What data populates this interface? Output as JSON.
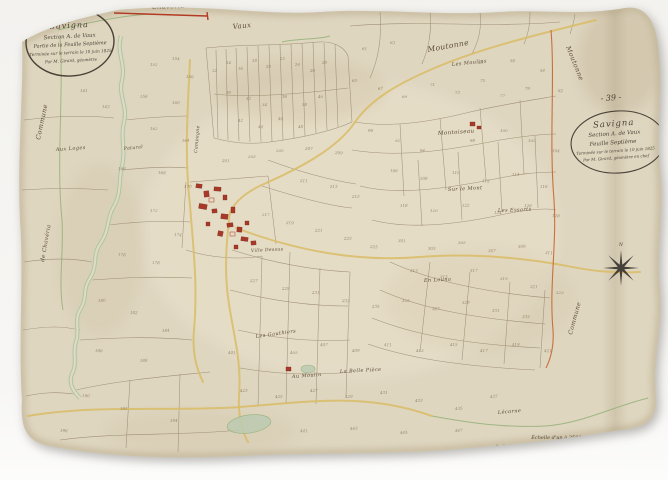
{
  "document": {
    "description": "Scanned hand-drawn Napoleonic cadastre map sheet on aged paper",
    "commune": "Savigna",
    "section": "Section A. de Vaux",
    "sheet": "Feuille Septième"
  },
  "cartouche_left": {
    "title": "Savigna",
    "line2": "Section A. de Vaux",
    "line3": "Partie de la Feuille Septième",
    "line4": "Terminée sur le terrain le 10 juin 1825",
    "line5": "Par M. Girard, géomètre"
  },
  "cartouche_right": {
    "page_number": "- 39 -",
    "title": "Savigna",
    "line2": "Section A. de Vaux",
    "line3": "Feuille Septième",
    "line4": "Terminée sur le terrain le 10 juin 1825",
    "line5": "Par M. Girard, géomètre en chef"
  },
  "stamps": {
    "bottom_left_page_number": "7"
  },
  "scale_bar": {
    "label": "Échelle d'un à 2500 mètres"
  },
  "compass": {
    "north_label": "N"
  },
  "colors": {
    "paper": "#dfd6c0",
    "parcel_line": "#8a795d",
    "road": "#d9bc66",
    "river": "#a9c29b",
    "boundary_red": "#b23b25",
    "boundary_orange": "#c4652f",
    "building_red": "#a83828",
    "ink": "#4e4234"
  },
  "map": {
    "place_labels": [
      {
        "text": "Vaux",
        "x": 233,
        "y": 29,
        "rot": -6,
        "size": 7
      },
      {
        "text": "Moutonne",
        "x": 428,
        "y": 52,
        "rot": -10,
        "size": 7.5
      },
      {
        "text": "Les Moulins",
        "x": 452,
        "y": 66,
        "rot": -6,
        "size": 5
      },
      {
        "text": "Montoiseau",
        "x": 438,
        "y": 135,
        "rot": -4,
        "size": 5.5
      },
      {
        "text": "Sur le Mont",
        "x": 448,
        "y": 191,
        "rot": -3,
        "size": 5
      },
      {
        "text": "Les Essarts",
        "x": 498,
        "y": 212,
        "rot": -2,
        "size": 5
      },
      {
        "text": "En Louna",
        "x": 424,
        "y": 282,
        "rot": -3,
        "size": 5
      },
      {
        "text": "Aux Loges",
        "x": 56,
        "y": 151,
        "rot": -4,
        "size": 5
      },
      {
        "text": "Patural",
        "x": 124,
        "y": 150,
        "rot": -6,
        "size": 4.5
      },
      {
        "text": "Les Gauthiers",
        "x": 256,
        "y": 338,
        "rot": -8,
        "size": 5
      },
      {
        "text": "Au Moulin",
        "x": 292,
        "y": 378,
        "rot": -4,
        "size": 5
      },
      {
        "text": "La Belle Pièce",
        "x": 340,
        "y": 373,
        "rot": -3,
        "size": 5
      },
      {
        "text": "Ville Dessus",
        "x": 251,
        "y": 252,
        "rot": -3,
        "size": 4.5
      },
      {
        "text": "Lécorne",
        "x": 498,
        "y": 414,
        "rot": -5,
        "size": 5
      },
      {
        "text": "Campagne",
        "x": 197,
        "y": 153,
        "rot": -85,
        "size": 4.5
      },
      {
        "text": "Commune",
        "x": 40,
        "y": 140,
        "rot": -78,
        "size": 6.5
      },
      {
        "text": "de Chavéria",
        "x": 44,
        "y": 262,
        "rot": -80,
        "size": 5.5
      },
      {
        "text": "Commune",
        "x": 572,
        "y": 335,
        "rot": -75,
        "size": 6
      },
      {
        "text": "Moutonne",
        "x": 566,
        "y": 47,
        "rot": 68,
        "size": 6.5,
        "color": "#9a5030"
      },
      {
        "text": "Chavéria",
        "x": 152,
        "y": 9,
        "rot": -2,
        "size": 6.5,
        "color": "#7a3c22"
      }
    ],
    "parcel_numbers": [
      [
        80,
        92,
        "141"
      ],
      [
        102,
        108,
        "143"
      ],
      [
        150,
        66,
        "152"
      ],
      [
        172,
        60,
        "154"
      ],
      [
        186,
        78,
        "156"
      ],
      [
        140,
        98,
        "158"
      ],
      [
        172,
        104,
        "160"
      ],
      [
        150,
        130,
        "162"
      ],
      [
        182,
        142,
        "164"
      ],
      [
        118,
        170,
        "166"
      ],
      [
        158,
        174,
        "168"
      ],
      [
        184,
        188,
        "170"
      ],
      [
        150,
        212,
        "172"
      ],
      [
        174,
        236,
        "174"
      ],
      [
        118,
        256,
        "176"
      ],
      [
        152,
        264,
        "178"
      ],
      [
        98,
        302,
        "180"
      ],
      [
        130,
        314,
        "182"
      ],
      [
        162,
        332,
        "184"
      ],
      [
        95,
        352,
        "186"
      ],
      [
        140,
        362,
        "188"
      ],
      [
        82,
        397,
        "190"
      ],
      [
        120,
        410,
        "192"
      ],
      [
        170,
        422,
        "194"
      ],
      [
        60,
        432,
        "196"
      ],
      [
        212,
        72,
        "12"
      ],
      [
        226,
        64,
        "14"
      ],
      [
        238,
        70,
        "16"
      ],
      [
        252,
        62,
        "18"
      ],
      [
        266,
        68,
        "20"
      ],
      [
        280,
        60,
        "22"
      ],
      [
        295,
        66,
        "24"
      ],
      [
        310,
        72,
        "26"
      ],
      [
        322,
        64,
        "28"
      ],
      [
        226,
        94,
        "30"
      ],
      [
        246,
        100,
        "32"
      ],
      [
        262,
        106,
        "34"
      ],
      [
        282,
        98,
        "36"
      ],
      [
        302,
        106,
        "38"
      ],
      [
        318,
        98,
        "40"
      ],
      [
        238,
        122,
        "42"
      ],
      [
        258,
        128,
        "44"
      ],
      [
        278,
        120,
        "46"
      ],
      [
        298,
        128,
        "48"
      ],
      [
        362,
        50,
        "61"
      ],
      [
        390,
        44,
        "63"
      ],
      [
        352,
        82,
        "65"
      ],
      [
        378,
        90,
        "67"
      ],
      [
        402,
        98,
        "69"
      ],
      [
        430,
        86,
        "71"
      ],
      [
        455,
        94,
        "73"
      ],
      [
        480,
        82,
        "75"
      ],
      [
        500,
        97,
        "77"
      ],
      [
        525,
        90,
        "79"
      ],
      [
        478,
        64,
        "58"
      ],
      [
        510,
        62,
        "56"
      ],
      [
        540,
        72,
        "54"
      ],
      [
        558,
        92,
        "82"
      ],
      [
        368,
        132,
        "90"
      ],
      [
        395,
        142,
        "92"
      ],
      [
        420,
        152,
        "94"
      ],
      [
        470,
        142,
        "98"
      ],
      [
        500,
        132,
        "100"
      ],
      [
        528,
        142,
        "102"
      ],
      [
        552,
        152,
        "104"
      ],
      [
        390,
        172,
        "106"
      ],
      [
        420,
        180,
        "108"
      ],
      [
        452,
        174,
        "110"
      ],
      [
        482,
        182,
        "112"
      ],
      [
        512,
        176,
        "114"
      ],
      [
        540,
        188,
        "116"
      ],
      [
        400,
        207,
        "118"
      ],
      [
        430,
        212,
        "120"
      ],
      [
        462,
        207,
        "122"
      ],
      [
        494,
        214,
        "124"
      ],
      [
        524,
        207,
        "126"
      ],
      [
        552,
        217,
        "128"
      ],
      [
        222,
        162,
        "201"
      ],
      [
        248,
        158,
        "203"
      ],
      [
        276,
        152,
        "205"
      ],
      [
        305,
        150,
        "207"
      ],
      [
        335,
        154,
        "209"
      ],
      [
        300,
        182,
        "211"
      ],
      [
        330,
        188,
        "213"
      ],
      [
        352,
        198,
        "215"
      ],
      [
        262,
        216,
        "217"
      ],
      [
        286,
        224,
        "219"
      ],
      [
        315,
        232,
        "221"
      ],
      [
        344,
        240,
        "223"
      ],
      [
        370,
        248,
        "225"
      ],
      [
        250,
        282,
        "227"
      ],
      [
        282,
        290,
        "229"
      ],
      [
        312,
        294,
        "231"
      ],
      [
        342,
        302,
        "233"
      ],
      [
        372,
        308,
        "235"
      ],
      [
        398,
        242,
        "301"
      ],
      [
        428,
        250,
        "303"
      ],
      [
        458,
        244,
        "305"
      ],
      [
        488,
        252,
        "307"
      ],
      [
        518,
        248,
        "309"
      ],
      [
        545,
        254,
        "311"
      ],
      [
        410,
        272,
        "313"
      ],
      [
        440,
        278,
        "315"
      ],
      [
        470,
        272,
        "317"
      ],
      [
        500,
        280,
        "319"
      ],
      [
        530,
        288,
        "321"
      ],
      [
        556,
        294,
        "323"
      ],
      [
        402,
        302,
        "325"
      ],
      [
        432,
        310,
        "327"
      ],
      [
        462,
        304,
        "329"
      ],
      [
        492,
        312,
        "331"
      ],
      [
        522,
        318,
        "333"
      ],
      [
        228,
        354,
        "401"
      ],
      [
        290,
        354,
        "405"
      ],
      [
        320,
        346,
        "407"
      ],
      [
        352,
        352,
        "409"
      ],
      [
        384,
        346,
        "411"
      ],
      [
        416,
        352,
        "413"
      ],
      [
        450,
        346,
        "415"
      ],
      [
        480,
        352,
        "417"
      ],
      [
        512,
        346,
        "419"
      ],
      [
        544,
        352,
        "421"
      ],
      [
        240,
        392,
        "423"
      ],
      [
        275,
        398,
        "425"
      ],
      [
        310,
        392,
        "427"
      ],
      [
        345,
        398,
        "429"
      ],
      [
        380,
        394,
        "431"
      ],
      [
        415,
        402,
        "433"
      ],
      [
        455,
        410,
        "435"
      ],
      [
        490,
        398,
        "437"
      ],
      [
        300,
        432,
        "441"
      ],
      [
        350,
        430,
        "443"
      ],
      [
        400,
        434,
        "445"
      ],
      [
        455,
        432,
        "447"
      ]
    ]
  }
}
